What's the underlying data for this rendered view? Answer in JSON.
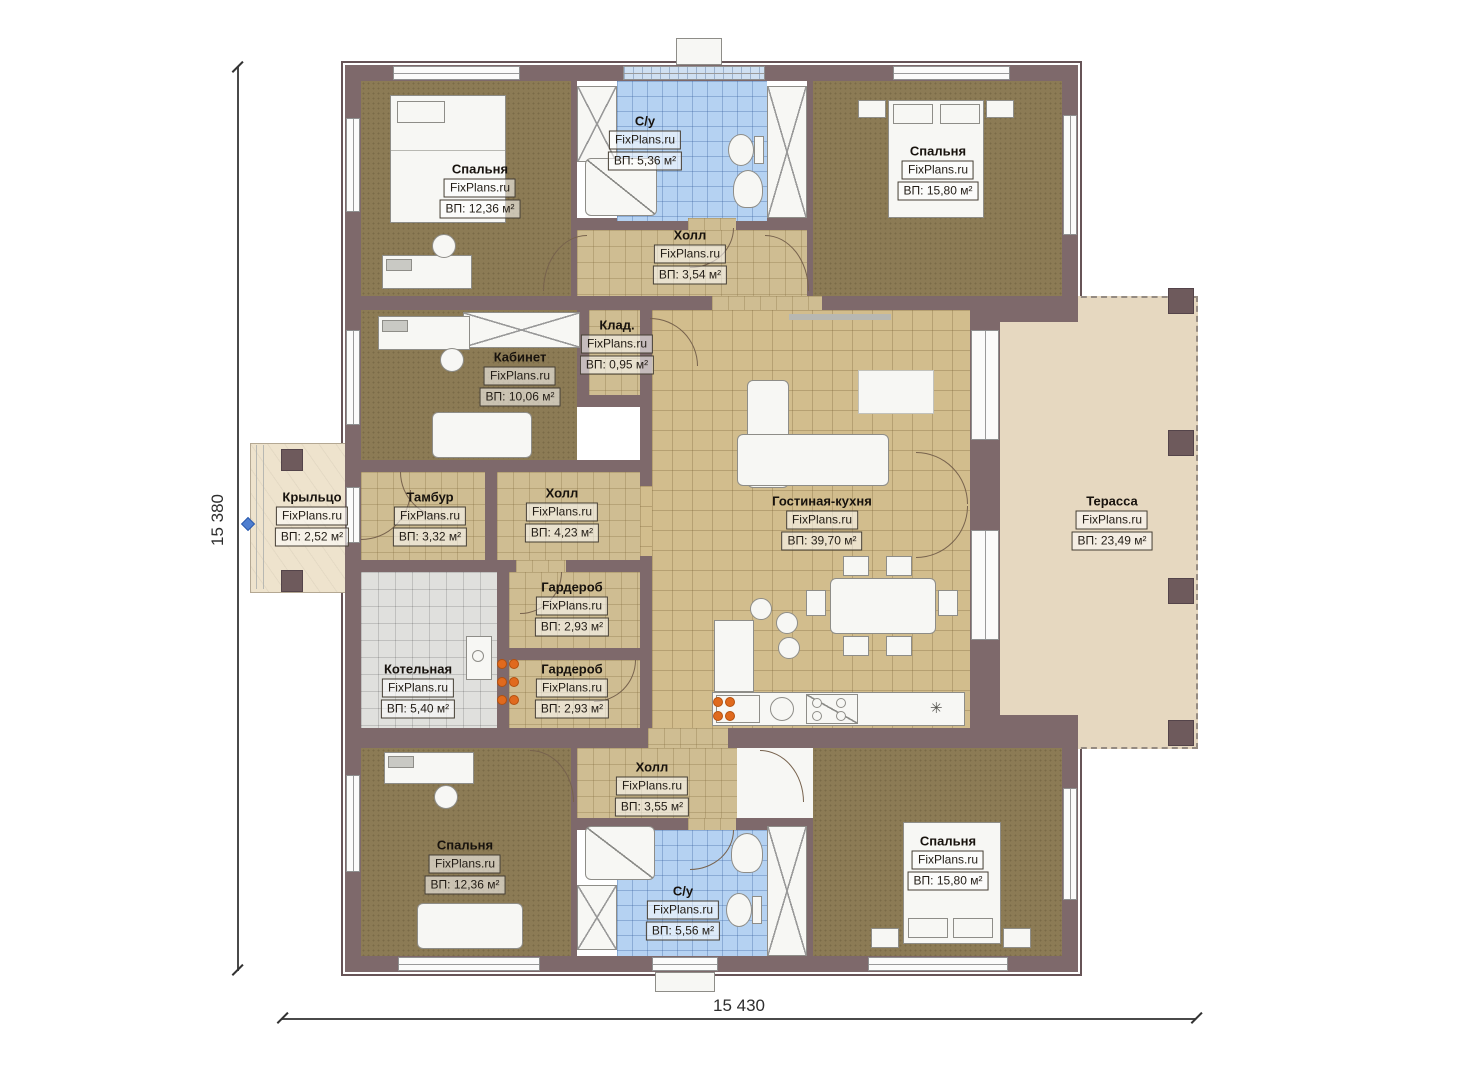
{
  "plan": {
    "brand": "FixPlans.ru",
    "dimensions": {
      "left": "15 380",
      "bottom": "15 430"
    }
  },
  "rooms": [
    {
      "id": "bedroom-top-left",
      "name": "Спальня",
      "brand": "FixPlans.ru",
      "area": "ВП: 12,36 м²"
    },
    {
      "id": "bathroom-top",
      "name": "С/у",
      "brand": "FixPlans.ru",
      "area": "ВП: 5,36 м²"
    },
    {
      "id": "bedroom-top-right",
      "name": "Спальня",
      "brand": "FixPlans.ru",
      "area": "ВП: 15,80 м²"
    },
    {
      "id": "hall-top",
      "name": "Холл",
      "brand": "FixPlans.ru",
      "area": "ВП: 3,54 м²"
    },
    {
      "id": "storage",
      "name": "Клад.",
      "brand": "FixPlans.ru",
      "area": "ВП: 0,95 м²"
    },
    {
      "id": "office",
      "name": "Кабинет",
      "brand": "FixPlans.ru",
      "area": "ВП: 10,06 м²"
    },
    {
      "id": "porch",
      "name": "Крыльцо",
      "brand": "FixPlans.ru",
      "area": "ВП: 2,52 м²"
    },
    {
      "id": "vestibule",
      "name": "Тамбур",
      "brand": "FixPlans.ru",
      "area": "ВП: 3,32 м²"
    },
    {
      "id": "hall-middle",
      "name": "Холл",
      "brand": "FixPlans.ru",
      "area": "ВП: 4,23 м²"
    },
    {
      "id": "living-kitchen",
      "name": "Гостиная-кухня",
      "brand": "FixPlans.ru",
      "area": "ВП: 39,70 м²"
    },
    {
      "id": "terrace",
      "name": "Терасса",
      "brand": "FixPlans.ru",
      "area": "ВП: 23,49 м²"
    },
    {
      "id": "wardrobe-upper",
      "name": "Гардероб",
      "brand": "FixPlans.ru",
      "area": "ВП: 2,93 м²"
    },
    {
      "id": "boiler-room",
      "name": "Котельная",
      "brand": "FixPlans.ru",
      "area": "ВП: 5,40 м²"
    },
    {
      "id": "wardrobe-lower",
      "name": "Гардероб",
      "brand": "FixPlans.ru",
      "area": "ВП: 2,93 м²"
    },
    {
      "id": "hall-bottom",
      "name": "Холл",
      "brand": "FixPlans.ru",
      "area": "ВП: 3,55 м²"
    },
    {
      "id": "bedroom-bottom-left",
      "name": "Спальня",
      "brand": "FixPlans.ru",
      "area": "ВП: 12,36 м²"
    },
    {
      "id": "bathroom-bottom",
      "name": "С/у",
      "brand": "FixPlans.ru",
      "area": "ВП: 5,56 м²"
    },
    {
      "id": "bedroom-bottom-right",
      "name": "Спальня",
      "brand": "FixPlans.ru",
      "area": "ВП: 15,80 м²"
    }
  ],
  "colors": {
    "wall": "#7e696b",
    "carpet": "#8c7b55",
    "tile": "#cfbd92",
    "living_tile": "#d2bd8d",
    "bath_tile": "#b5d2f2",
    "boiler_tile": "#e0e0dd",
    "terrace": "#e6d8c0",
    "burner_orange": "#e06a1e",
    "dimension_marker_blue": "#4f7fd0"
  }
}
